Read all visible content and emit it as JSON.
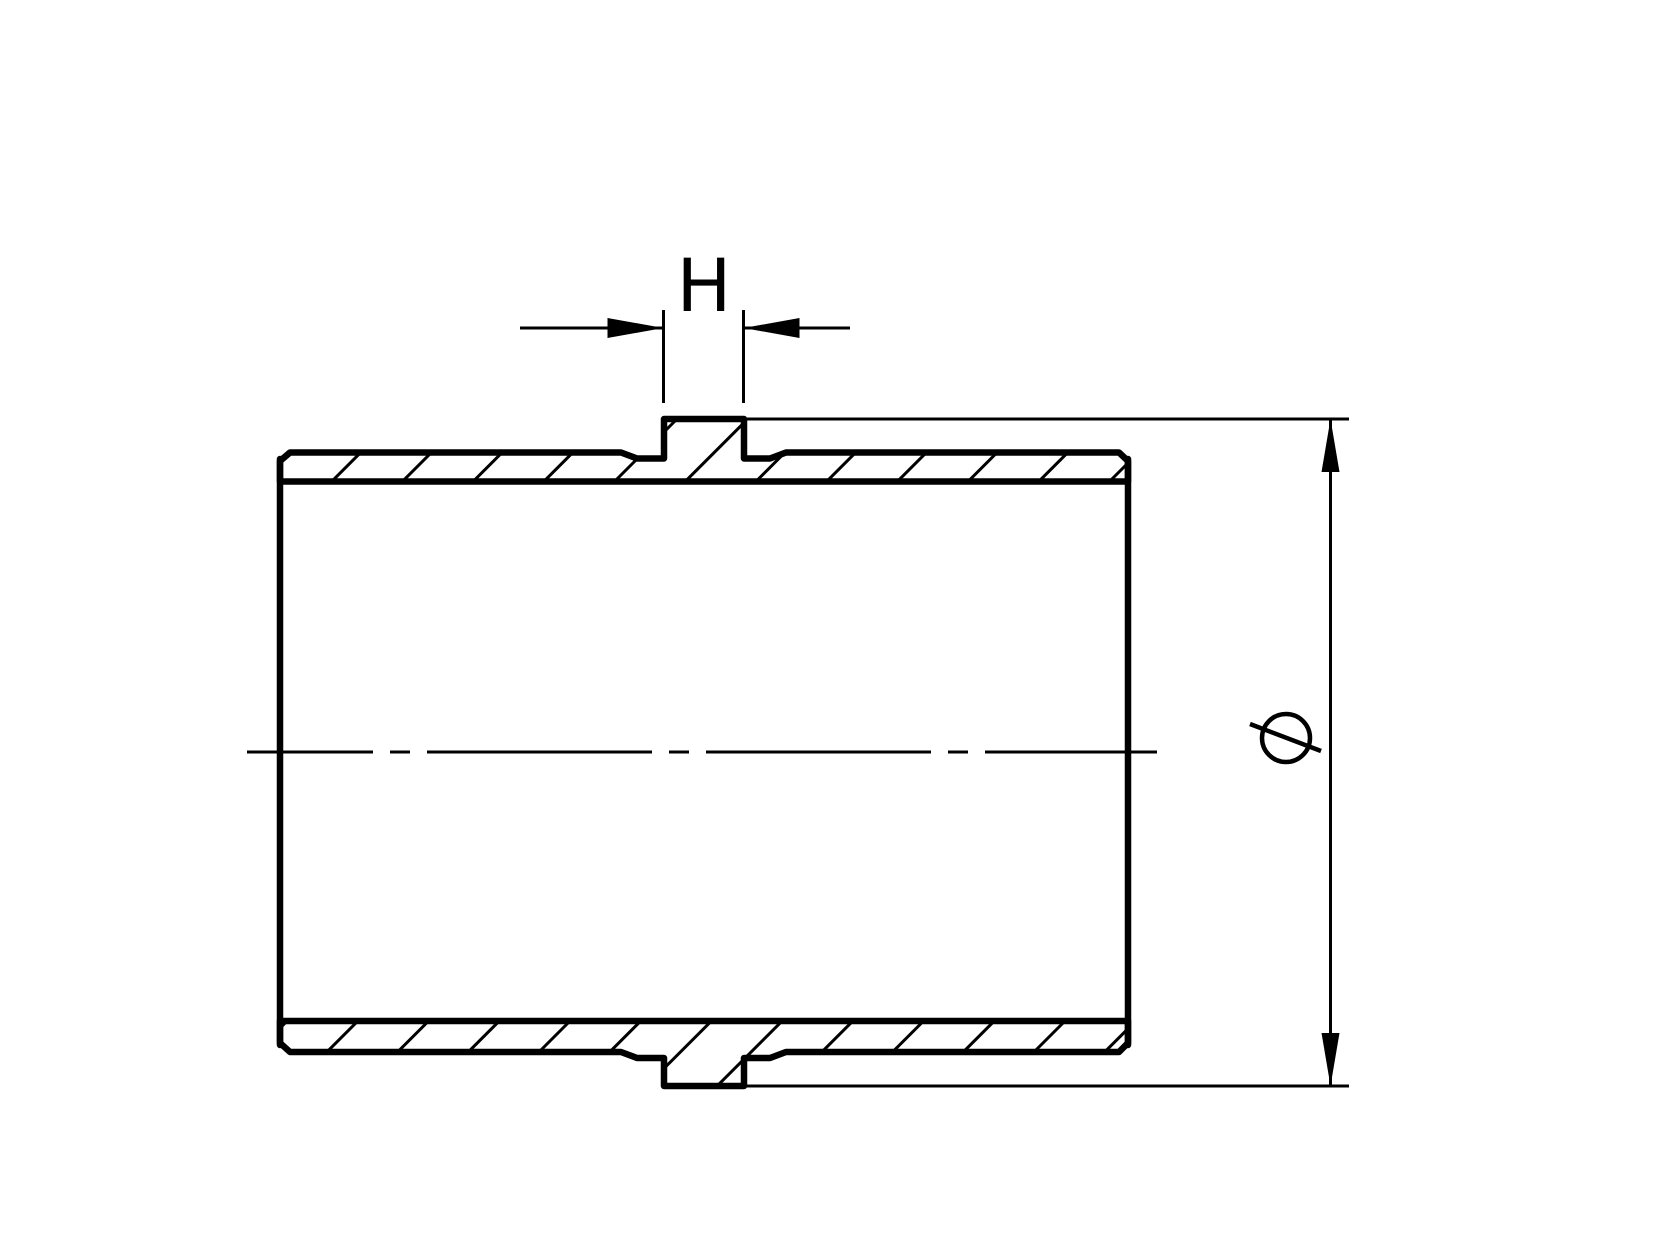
{
  "canvas": {
    "background": "#ffffff",
    "line_color": "#000000"
  },
  "annotations": {
    "h_dimension": {
      "label": "H"
    },
    "diameter_dimension": {
      "symbol": "Ø"
    }
  }
}
